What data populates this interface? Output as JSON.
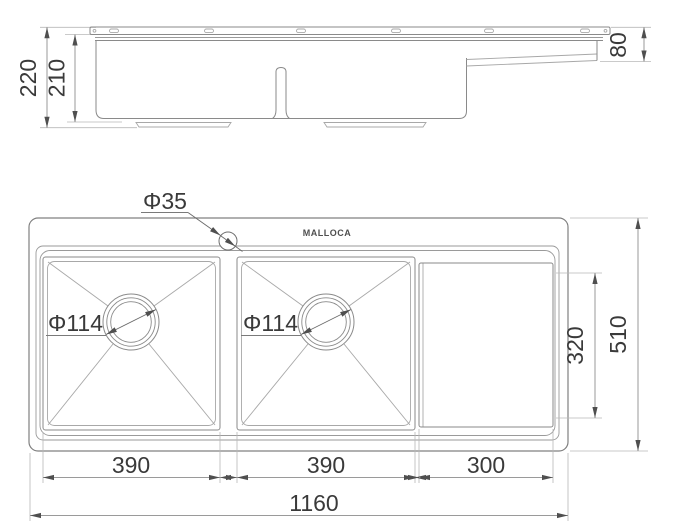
{
  "side_view": {
    "overall_depth": "220",
    "bowl_depth": "210",
    "right_ledge_depth": "80"
  },
  "plan_view": {
    "brand": "MALLOCA",
    "faucet_hole": "Φ35",
    "drain_left": "Φ114",
    "drain_right": "Φ114",
    "bowl_left_width": "390",
    "bowl_right_width": "390",
    "drainboard_width": "300",
    "overall_width": "1160",
    "drainboard_length": "320",
    "overall_length": "510"
  },
  "colors": {
    "background": "#ffffff",
    "object_line": "#8a8a8a",
    "dimension_line": "#9a9a9a",
    "extension_line": "#b8b8b8",
    "text": "#3a3a3a",
    "arrow": "#4f4f4f"
  }
}
